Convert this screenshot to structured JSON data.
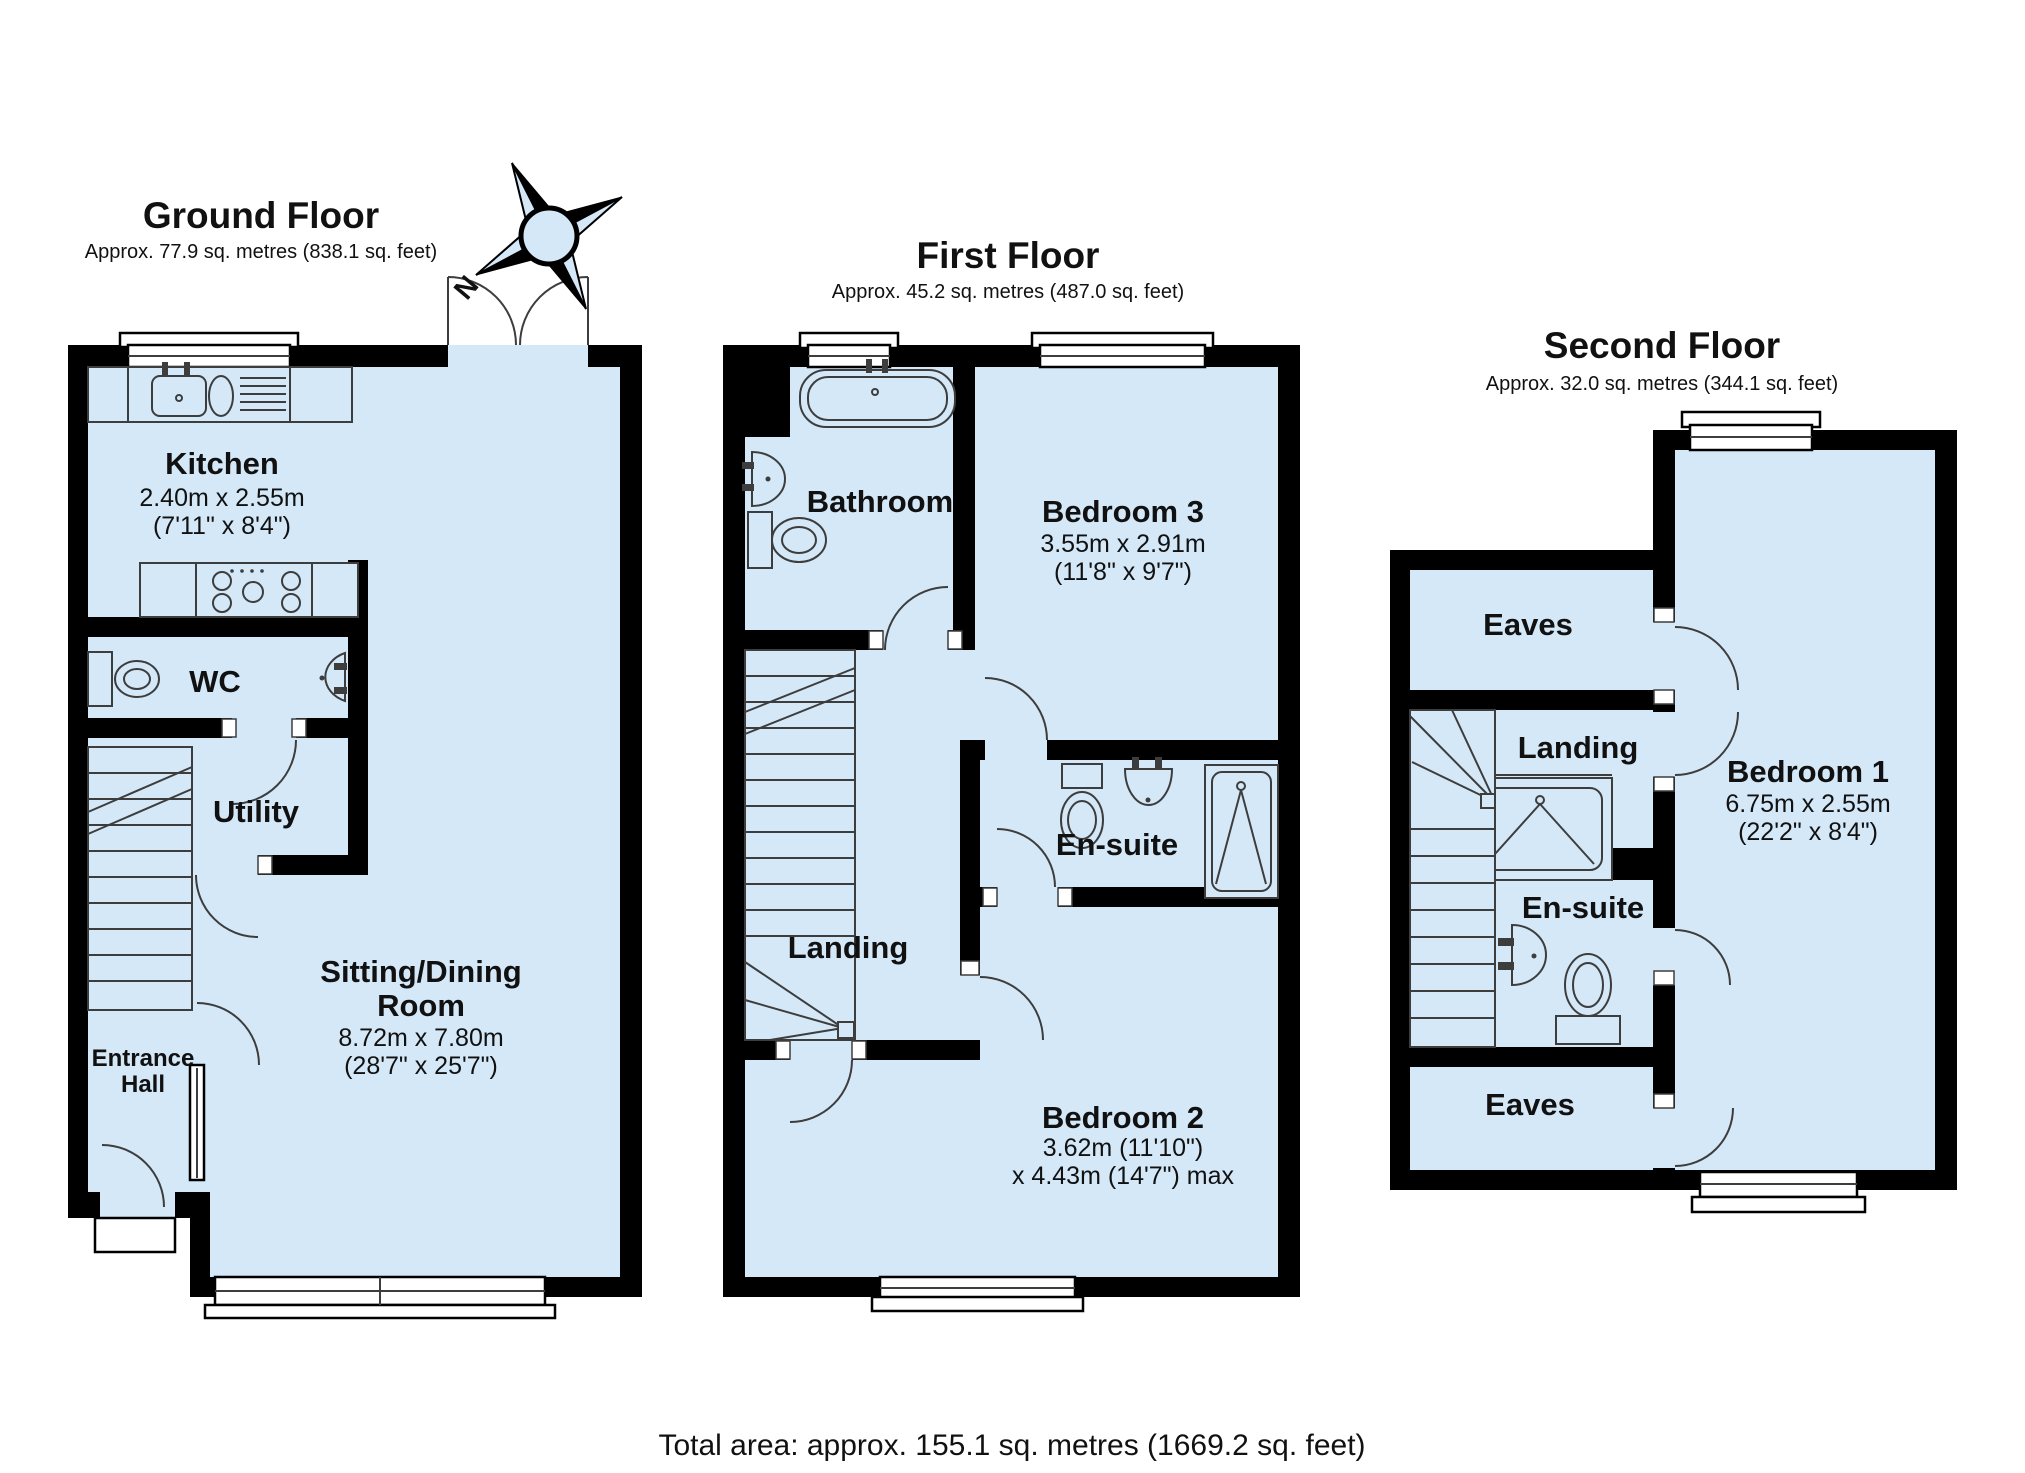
{
  "colors": {
    "room_fill": "#d4e8f8",
    "wall": "#000000",
    "line": "#3d3d3d",
    "window_fill": "#ffffff",
    "background": "#ffffff",
    "text": "#111111"
  },
  "compass": {
    "north_label": "N"
  },
  "total_area_label": "Total area: approx. 155.1 sq. metres (1669.2 sq. feet)",
  "floors": {
    "ground": {
      "title": "Ground Floor",
      "subtitle": "Approx. 77.9 sq. metres (838.1 sq. feet)",
      "rooms": {
        "kitchen": {
          "name": "Kitchen",
          "dims_metric": "2.40m x 2.55m",
          "dims_imperial": "(7'11\" x 8'4\")"
        },
        "wc": {
          "name": "WC"
        },
        "utility": {
          "name": "Utility"
        },
        "entrance_hall": {
          "line1": "Entrance",
          "line2": "Hall"
        },
        "sitting_dining": {
          "name_line1": "Sitting/Dining",
          "name_line2": "Room",
          "dims_metric": "8.72m x 7.80m",
          "dims_imperial": "(28'7\" x 25'7\")"
        }
      }
    },
    "first": {
      "title": "First Floor",
      "subtitle": "Approx. 45.2 sq. metres (487.0 sq. feet)",
      "rooms": {
        "bathroom": {
          "name": "Bathroom"
        },
        "bedroom3": {
          "name": "Bedroom 3",
          "dims_metric": "3.55m x 2.91m",
          "dims_imperial": "(11'8\" x 9'7\")"
        },
        "ensuite": {
          "name": "En-suite"
        },
        "landing": {
          "name": "Landing"
        },
        "bedroom2": {
          "name": "Bedroom 2",
          "dims_line1": "3.62m (11'10\")",
          "dims_line2": "x 4.43m (14'7\") max"
        }
      }
    },
    "second": {
      "title": "Second Floor",
      "subtitle": "Approx. 32.0 sq. metres (344.1 sq. feet)",
      "rooms": {
        "eaves_top": {
          "name": "Eaves"
        },
        "landing": {
          "name": "Landing"
        },
        "ensuite": {
          "name": "En-suite"
        },
        "bedroom1": {
          "name": "Bedroom 1",
          "dims_metric": "6.75m x 2.55m",
          "dims_imperial": "(22'2\" x 8'4\")"
        },
        "eaves_bottom": {
          "name": "Eaves"
        }
      }
    }
  }
}
